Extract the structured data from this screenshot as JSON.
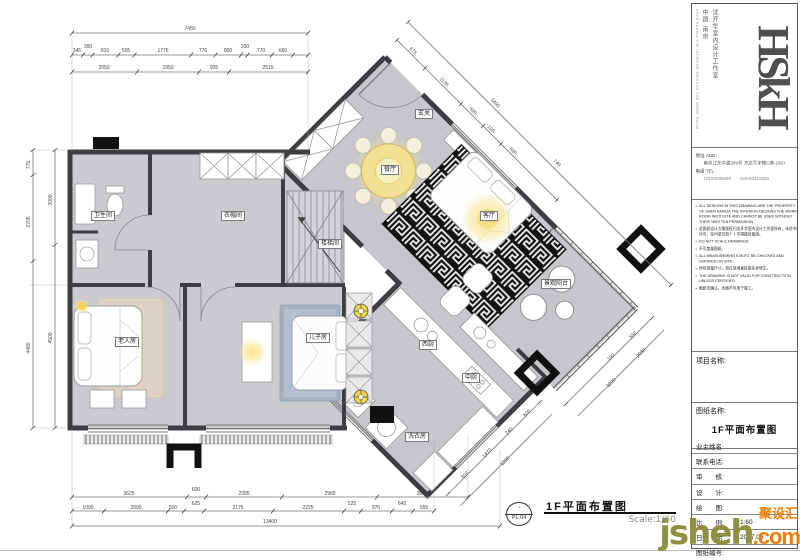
{
  "plan": {
    "rooms": {
      "bathroom": "卫生间",
      "cloakroom": "衣帽间",
      "stairwell": "楼梯间",
      "elder_room": "老人房",
      "son_room": "儿子房",
      "entry": "玄关",
      "dining": "餐厅",
      "living": "客厅",
      "balcony": "景观阳台",
      "west_kitchen": "西厨",
      "chinese_kitchen": "中厨",
      "laundry": "洗衣房"
    }
  },
  "dims": {
    "top_total": "7450",
    "top_row1": [
      "345",
      "300",
      "810",
      "505",
      "1775",
      "770",
      "800",
      "200",
      "770",
      "660"
    ],
    "top_row2": [
      "2050",
      "1950",
      "935",
      "2515"
    ],
    "left_outer": [
      "775",
      "2705",
      "4480"
    ],
    "left_inner": [
      "3000",
      "4500"
    ],
    "bottom_row1": [
      "3625",
      "600",
      "2395",
      "2980",
      "2865"
    ],
    "bottom_row2": [
      "1000",
      "2000",
      "500",
      "625",
      "2175",
      "2225",
      "525",
      "970",
      "645",
      "655"
    ],
    "bottom_total": "13400",
    "diag_ne": [
      "675",
      "1135",
      "500",
      "190",
      "600",
      "3400",
      "740"
    ],
    "diag_se": [
      "550",
      "190",
      "2930",
      "3200",
      "600",
      "240",
      "1470",
      "800",
      "1200"
    ]
  },
  "titleblock": {
    "brand": {
      "logo": "HSkH",
      "country": "中国·南京",
      "studio": "沈开华室内设计工作室",
      "studio_en": "SHEN KAIHUA THE INTERIOR DESIGNS THE WORK ROOM"
    },
    "contact": {
      "addr_label": "地址 ADD：",
      "addr": "南京江东中路289号 万达写字楼C座-2907",
      "tel_label": "电话 TEL：",
      "tel": "13182696099　　025-86310558"
    },
    "notes": [
      "ALL DESIGNS IN THIS DRAWING ARE THE PROPERTY OF SHEN KAIHUA THE INTERIOR DESIGNS THE WORK ROOM INSTITUTE AND CANNOT BE USED WITHOUT THEIR WRITTEN PERMISSION.",
      "此图纸设计方案版权归沈开华室内设计工作室所有，未经书面许可，任何单位和个人不得擅自使用。",
      "DO NOT SCALE DRAWINGS.",
      "不可度量图纸。",
      "ALL MEASUREMENTS MUST BE CHECKED AND VERIFIED ON SITE.",
      "所有测量尺寸，须在现场复核查实并修正。",
      "THE DRAWING IS NOT VALID FOR CONSTRUCTION UNLESS CERTIFIED.",
      "图纸未确认，本图不可用于施工。"
    ],
    "project_label": "项目名称:",
    "drawing_label": "图纸名称:",
    "drawing_name": "1F平面布置图",
    "fields": [
      {
        "label": "业主姓名:",
        "value": ""
      },
      {
        "label": "联系电话:",
        "value": ""
      },
      {
        "label": "审　　核:",
        "value": ""
      },
      {
        "label": "设　　计:",
        "value": ""
      },
      {
        "label": "绘　　图:",
        "value": ""
      },
      {
        "label": "比　　例:",
        "value": "1:60"
      },
      {
        "label": "日　　期:",
        "value": "2017.05"
      },
      {
        "label": "图纸编号:",
        "value": ""
      }
    ]
  },
  "footer": {
    "sheet_no": "PL.04",
    "title": "1F平面布置图",
    "scale": "Scale:1/60"
  },
  "watermark": {
    "brand": "聚设汇",
    "site_name": "jsheh",
    "site_tld": ".com"
  },
  "colors": {
    "wall": "#3d3d42",
    "floor": "#c9c9cd",
    "accent_yellow": "#f2e193",
    "rug_black": "#141414",
    "watermark_orange": "#f07d00"
  }
}
